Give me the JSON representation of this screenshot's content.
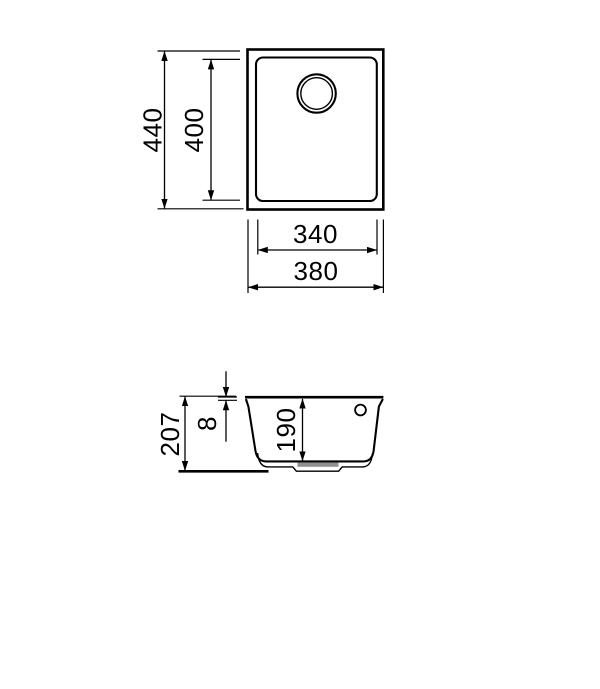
{
  "drawing": {
    "line_color": "#000000",
    "background_color": "#ffffff",
    "drain_shade_color": "#8f8f8f",
    "top_view": {
      "overall_height_mm": "440",
      "bowl_height_mm": "400",
      "bowl_width_mm": "340",
      "overall_width_mm": "380"
    },
    "section_view": {
      "overall_depth_mm": "207",
      "rim_thickness_mm": "8",
      "bowl_depth_mm": "190"
    }
  }
}
